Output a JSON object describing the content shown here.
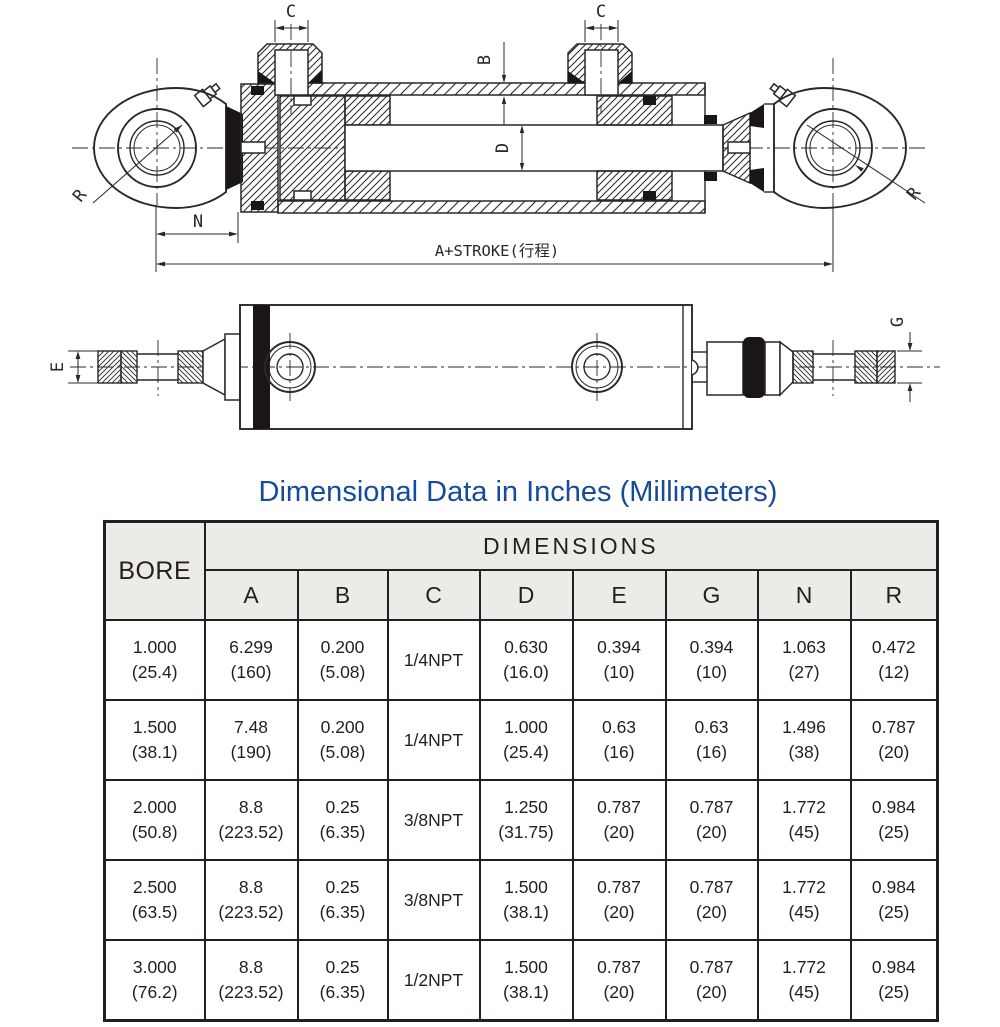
{
  "title": {
    "text": "Dimensional Data in Inches (Millimeters)",
    "color": "#164a9c"
  },
  "drawing": {
    "labels": {
      "c_left": "C",
      "c_right": "C",
      "b": "B",
      "d": "D",
      "r_left": "R",
      "r_right": "R",
      "n": "N",
      "a_stroke": "A+STROKE(行程)",
      "e": "E",
      "g": "G"
    }
  },
  "table": {
    "bore_header": "BORE",
    "dimensions_header": "DIMENSIONS",
    "columns": [
      "A",
      "B",
      "C",
      "D",
      "E",
      "G",
      "N",
      "R"
    ],
    "rows": [
      {
        "bore_in": "1.000",
        "bore_mm": "(25.4)",
        "a_in": "6.299",
        "a_mm": "(160)",
        "b_in": "0.200",
        "b_mm": "(5.08)",
        "c": "1/4NPT",
        "d_in": "0.630",
        "d_mm": "(16.0)",
        "e_in": "0.394",
        "e_mm": "(10)",
        "g_in": "0.394",
        "g_mm": "(10)",
        "n_in": "1.063",
        "n_mm": "(27)",
        "r_in": "0.472",
        "r_mm": "(12)"
      },
      {
        "bore_in": "1.500",
        "bore_mm": "(38.1)",
        "a_in": "7.48",
        "a_mm": "(190)",
        "b_in": "0.200",
        "b_mm": "(5.08)",
        "c": "1/4NPT",
        "d_in": "1.000",
        "d_mm": "(25.4)",
        "e_in": "0.63",
        "e_mm": "(16)",
        "g_in": "0.63",
        "g_mm": "(16)",
        "n_in": "1.496",
        "n_mm": "(38)",
        "r_in": "0.787",
        "r_mm": "(20)"
      },
      {
        "bore_in": "2.000",
        "bore_mm": "(50.8)",
        "a_in": "8.8",
        "a_mm": "(223.52)",
        "b_in": "0.25",
        "b_mm": "(6.35)",
        "c": "3/8NPT",
        "d_in": "1.250",
        "d_mm": "(31.75)",
        "e_in": "0.787",
        "e_mm": "(20)",
        "g_in": "0.787",
        "g_mm": "(20)",
        "n_in": "1.772",
        "n_mm": "(45)",
        "r_in": "0.984",
        "r_mm": "(25)"
      },
      {
        "bore_in": "2.500",
        "bore_mm": "(63.5)",
        "a_in": "8.8",
        "a_mm": "(223.52)",
        "b_in": "0.25",
        "b_mm": "(6.35)",
        "c": "3/8NPT",
        "d_in": "1.500",
        "d_mm": "(38.1)",
        "e_in": "0.787",
        "e_mm": "(20)",
        "g_in": "0.787",
        "g_mm": "(20)",
        "n_in": "1.772",
        "n_mm": "(45)",
        "r_in": "0.984",
        "r_mm": "(25)"
      },
      {
        "bore_in": "3.000",
        "bore_mm": "(76.2)",
        "a_in": "8.8",
        "a_mm": "(223.52)",
        "b_in": "0.25",
        "b_mm": "(6.35)",
        "c": "1/2NPT",
        "d_in": "1.500",
        "d_mm": "(38.1)",
        "e_in": "0.787",
        "e_mm": "(20)",
        "g_in": "0.787",
        "g_mm": "(20)",
        "n_in": "1.772",
        "n_mm": "(45)",
        "r_in": "0.984",
        "r_mm": "(25)"
      }
    ]
  }
}
